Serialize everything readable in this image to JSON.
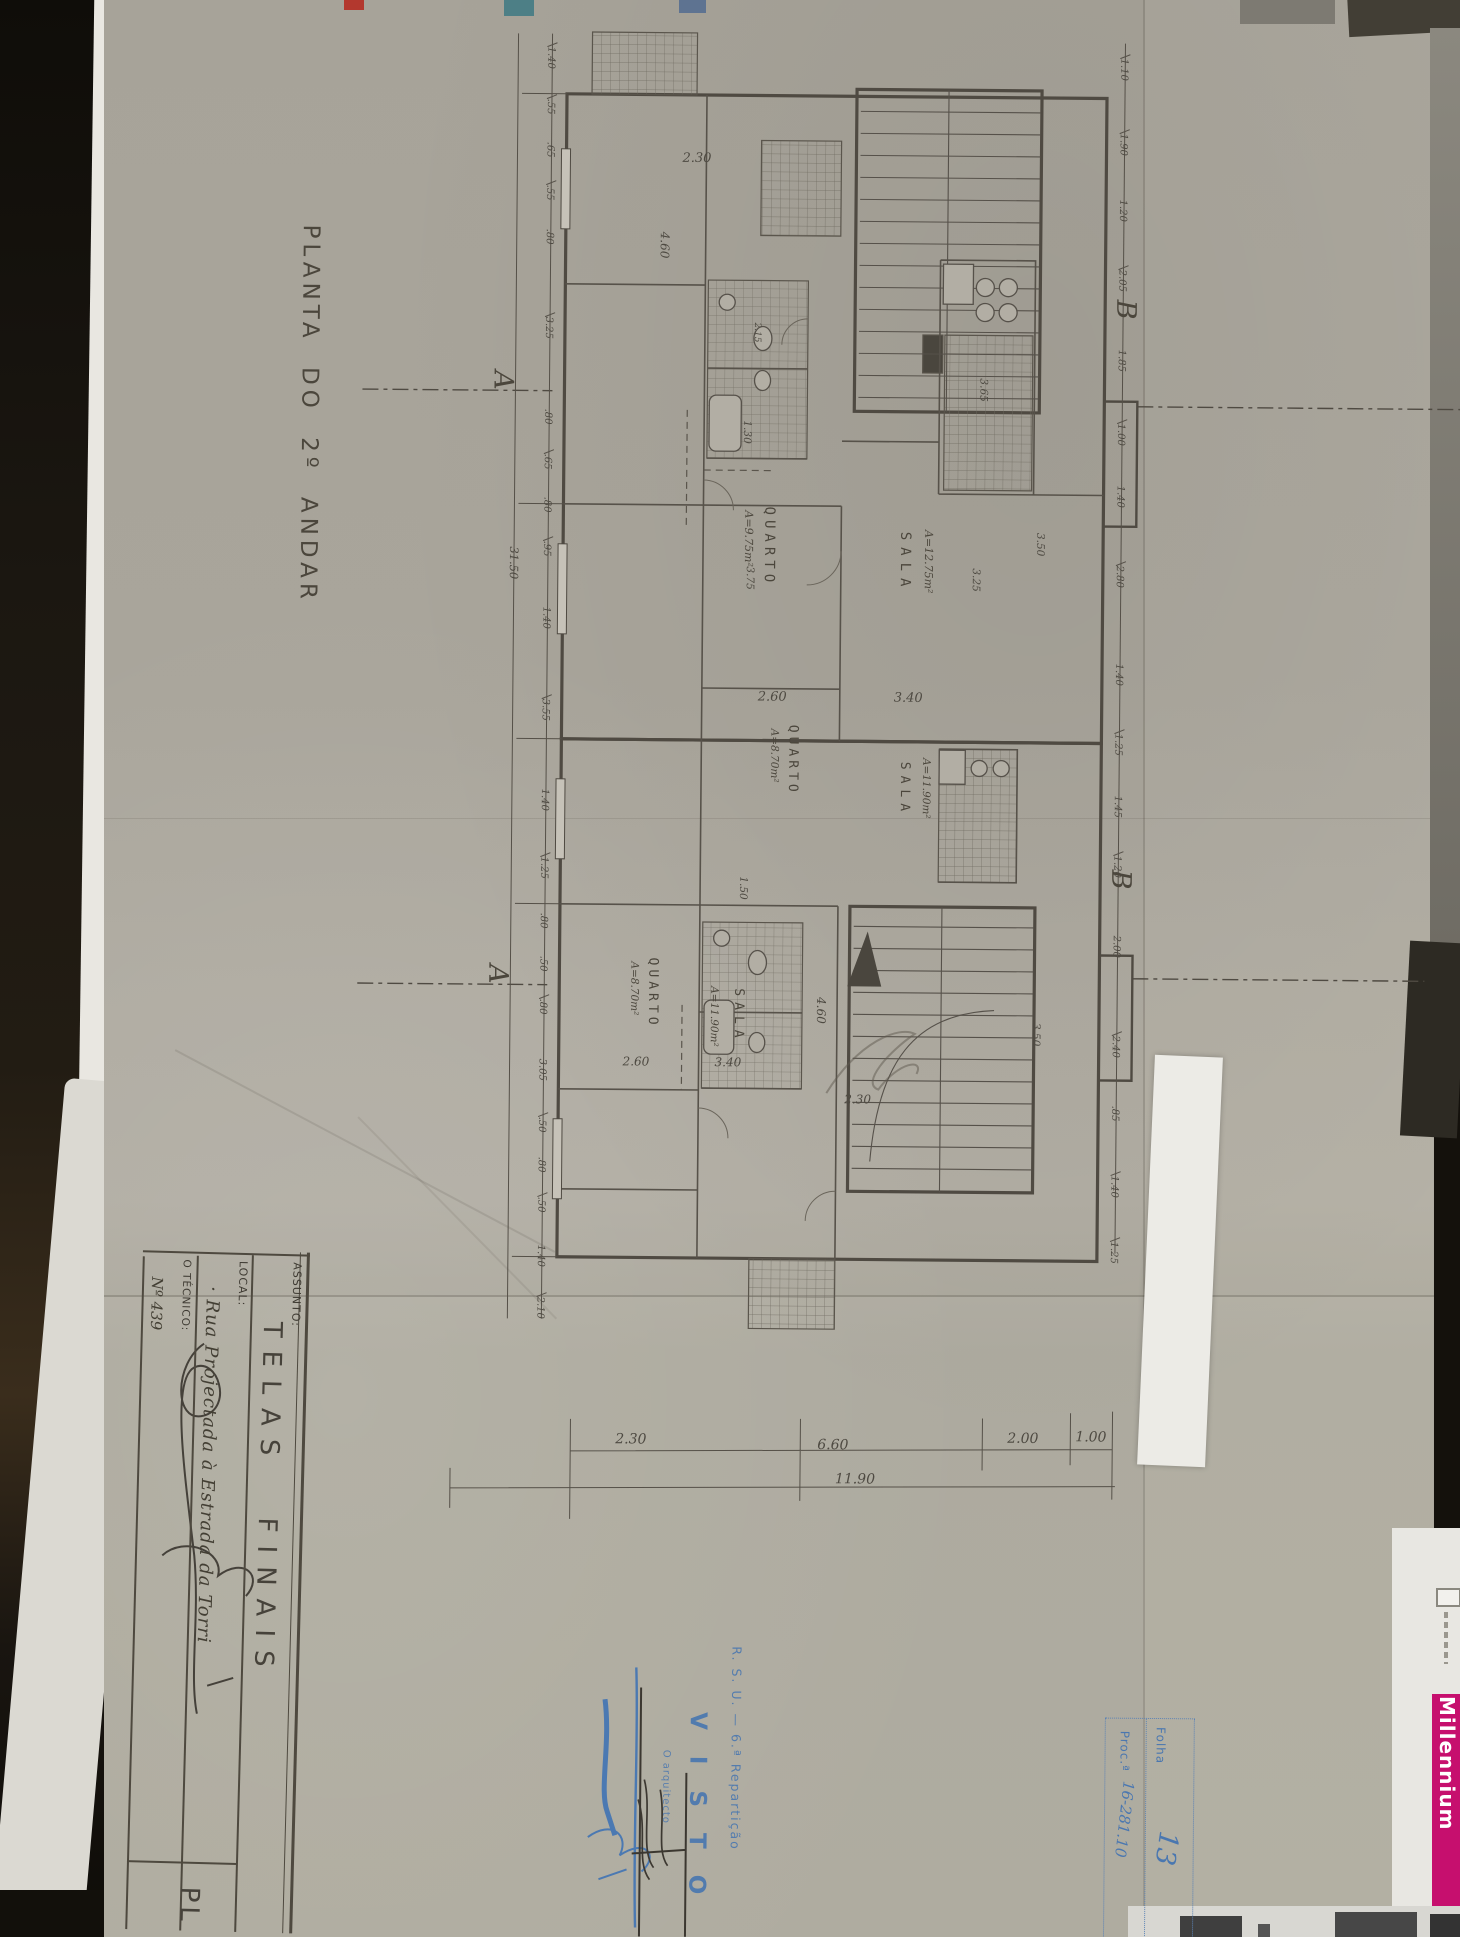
{
  "title": "PLANTA DO 2º ANDAR",
  "title_block": {
    "assunto_label": "ASSUNTO:",
    "assunto_value": "TELAS FINAIS",
    "local_label": "LOCAL:",
    "local_value": "· Rua Projectada à Estrada da Torri",
    "tecnico_label": "O TÉCNICO:",
    "tecnico_value": "Nº 439",
    "bottom_partial": "PL"
  },
  "stamp": {
    "org": "R. S. U. — 6.ª Repartição",
    "visto": "V I S T O",
    "signer": "O arquitecto",
    "folha_label": "Folha",
    "folha_value": "13",
    "proc_label": "Proc.ª",
    "proc_value": "16-281.10",
    "color": "#4a77b0"
  },
  "banner": {
    "text": "Millennium",
    "bg": "#c60f6e"
  },
  "plan": {
    "rooms": [
      {
        "name": "QUARTO",
        "area": "A=9.75m²"
      },
      {
        "name": "SALA",
        "area": "A=12.75m²"
      },
      {
        "name": "QUARTO",
        "area": "A=8.70m²"
      },
      {
        "name": "SALA",
        "area": "A=11.90m²"
      },
      {
        "name": "QUARTO",
        "area": "A=8.70m²"
      },
      {
        "name": "SALA",
        "area": "A=11.90m²"
      }
    ],
    "markers": {
      "a": "A",
      "b": "B"
    },
    "left_chain": [
      "1.40",
      ".55",
      ".65",
      ".55",
      ".80",
      "3.25",
      ".80",
      ".65",
      ".80",
      ".95",
      "1.40",
      "3.55",
      "1.40",
      "1.25",
      ".80",
      ".50",
      ".80",
      "3.05",
      ".50",
      ".80",
      ".50",
      "1.40",
      "2.10"
    ],
    "left_total": "31.50",
    "right_chain": [
      "1.10",
      "1.90",
      "1.20",
      "2.05",
      "1.85",
      "1.00",
      "1.40",
      "2.80",
      "1.40",
      "1.25",
      "1.45",
      "1.20",
      "2.00",
      "2.40",
      ".85",
      "1.40",
      "1.25"
    ],
    "bottom_chain": [
      "2.30",
      "6.60",
      "2.00",
      "1.00"
    ],
    "bottom_total": "11.90",
    "inner_dims": {
      "s230a": "2.30",
      "s460a": "4.60",
      "s130": "1.30",
      "s375": "3.75",
      "s325": "3.25",
      "s365": "3.65",
      "s350a": "3.50",
      "s260a": "2.60",
      "s340a": "3.40",
      "s150": "1.50",
      "s215": "2.15",
      "s460b": "4.60",
      "s230b": "2.30",
      "s260b": "2.60",
      "s340b": "3.40",
      "s350b": "3.50"
    }
  }
}
